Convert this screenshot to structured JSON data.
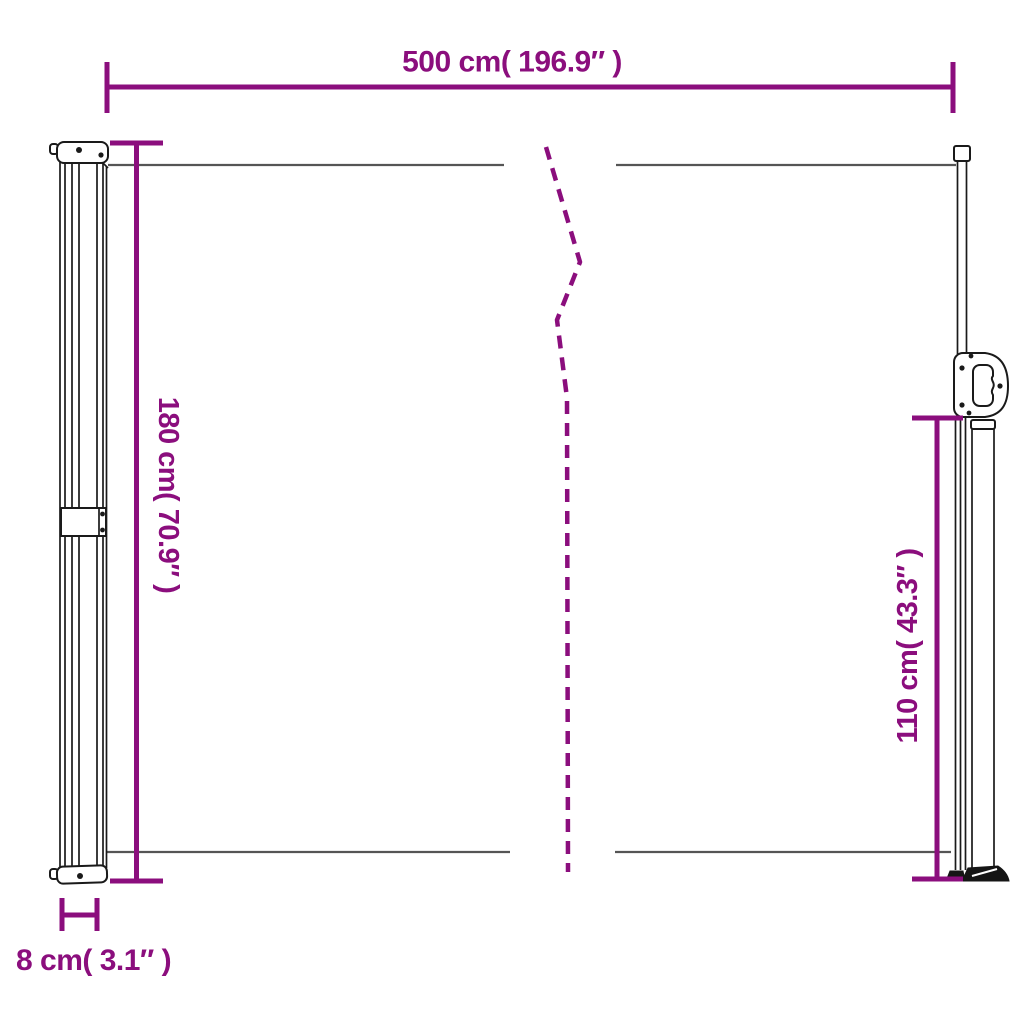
{
  "diagram": {
    "kind": "product-dimension-diagram"
  },
  "colors": {
    "dimension_accent": "#8b0e7d",
    "fabric_line": "#555555",
    "outline": "#1a1a1a",
    "background": "#ffffff"
  },
  "dimensions": {
    "width": {
      "label": "500 cm( 196.9″ )",
      "value_cm": 500,
      "value_in": 196.9
    },
    "height_left": {
      "label": "180 cm( 70.9″ )",
      "value_cm": 180,
      "value_in": 70.9
    },
    "height_right": {
      "label": "110 cm( 43.3″ )",
      "value_cm": 110,
      "value_in": 43.3
    },
    "depth": {
      "label": "8 cm( 3.1″ )",
      "value_cm": 8,
      "value_in": 3.1
    }
  }
}
